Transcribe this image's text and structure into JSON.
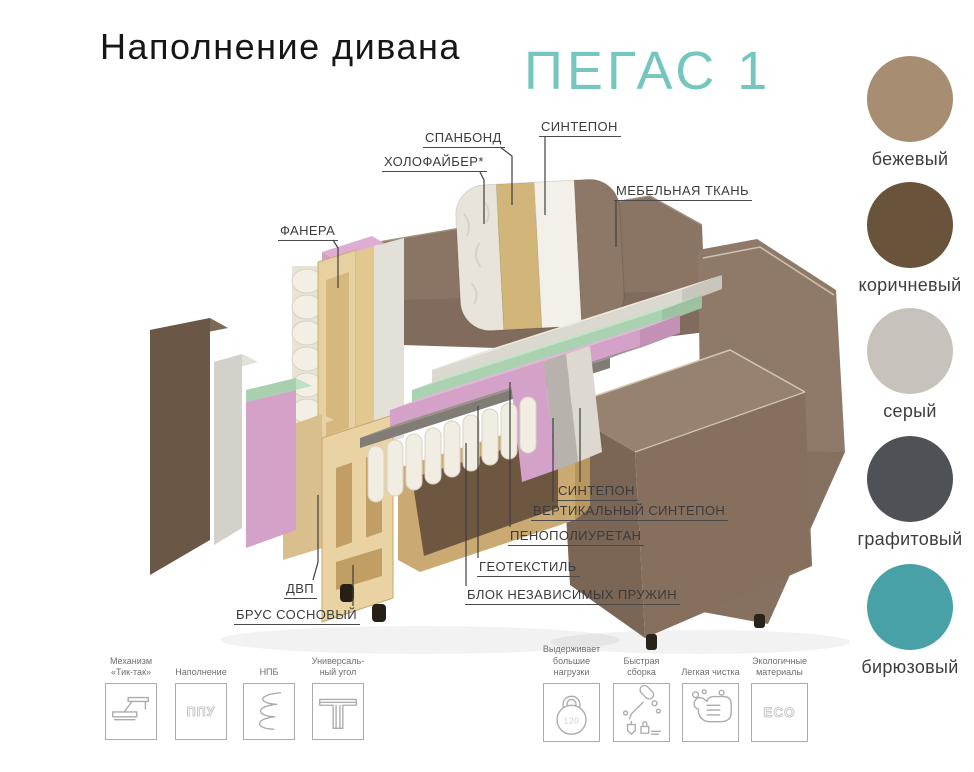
{
  "header": {
    "title": "Наполнение дивана",
    "model_name": "ПЕГАС 1",
    "accent_color": "#74c6be"
  },
  "diagram": {
    "part_labels": [
      {
        "id": "spunbond",
        "text": "СПАНБОНД"
      },
      {
        "id": "sintepon-top",
        "text": "СИНТЕПОН"
      },
      {
        "id": "holofiber",
        "text": "ХОЛОФАЙБЕР*"
      },
      {
        "id": "furniture-fabric",
        "text": "МЕБЕЛЬНАЯ ТКАНЬ"
      },
      {
        "id": "plywood",
        "text": "ФАНЕРА"
      },
      {
        "id": "sintepon-bottom",
        "text": "СИНТЕПОН"
      },
      {
        "id": "vertical-sintepon",
        "text": "ВЕРТИКАЛЬНЫЙ СИНТЕПОН"
      },
      {
        "id": "polyurethane-foam",
        "text": "ПЕНОПОЛИУРЕТАН"
      },
      {
        "id": "geotextile",
        "text": "ГЕОТЕКСТИЛЬ"
      },
      {
        "id": "spring-block",
        "text": "БЛОК НЕЗАВИСИМЫХ ПРУЖИН"
      },
      {
        "id": "fiberboard",
        "text": "ДВП"
      },
      {
        "id": "pine-timber",
        "text": "БРУС СОСНОВЫЙ"
      }
    ]
  },
  "fabric_colors": {
    "swatches": [
      {
        "name": "бежевый",
        "hex": "#a78d71"
      },
      {
        "name": "коричневый",
        "hex": "#6a533b"
      },
      {
        "name": "серый",
        "hex": "#c7c2bc"
      },
      {
        "name": "графитовый",
        "hex": "#4e5156"
      },
      {
        "name": "бирюзовый",
        "hex": "#47a1a7"
      }
    ]
  },
  "features": [
    {
      "icon": "tik-tak-mechanism-icon",
      "caption": "Механизм\n«Тик-так»"
    },
    {
      "icon": "ppu-filling-icon",
      "caption": "Наполнение",
      "icon_text": "ППУ"
    },
    {
      "icon": "spring-icon",
      "caption": "НПБ"
    },
    {
      "icon": "universal-corner-icon",
      "caption": "Универсаль-\nный угол"
    },
    {
      "icon": "kettlebell-icon",
      "caption": "Выдерживает\nбольшие\nнагрузки",
      "icon_text": "120"
    },
    {
      "icon": "quick-assembly-icon",
      "caption": "Быстрая\nсборка"
    },
    {
      "icon": "easy-cleaning-icon",
      "caption": "Легкая чистка"
    },
    {
      "icon": "eco-icon",
      "caption": "Экологичные\nматериалы",
      "icon_text": "ECO"
    }
  ]
}
